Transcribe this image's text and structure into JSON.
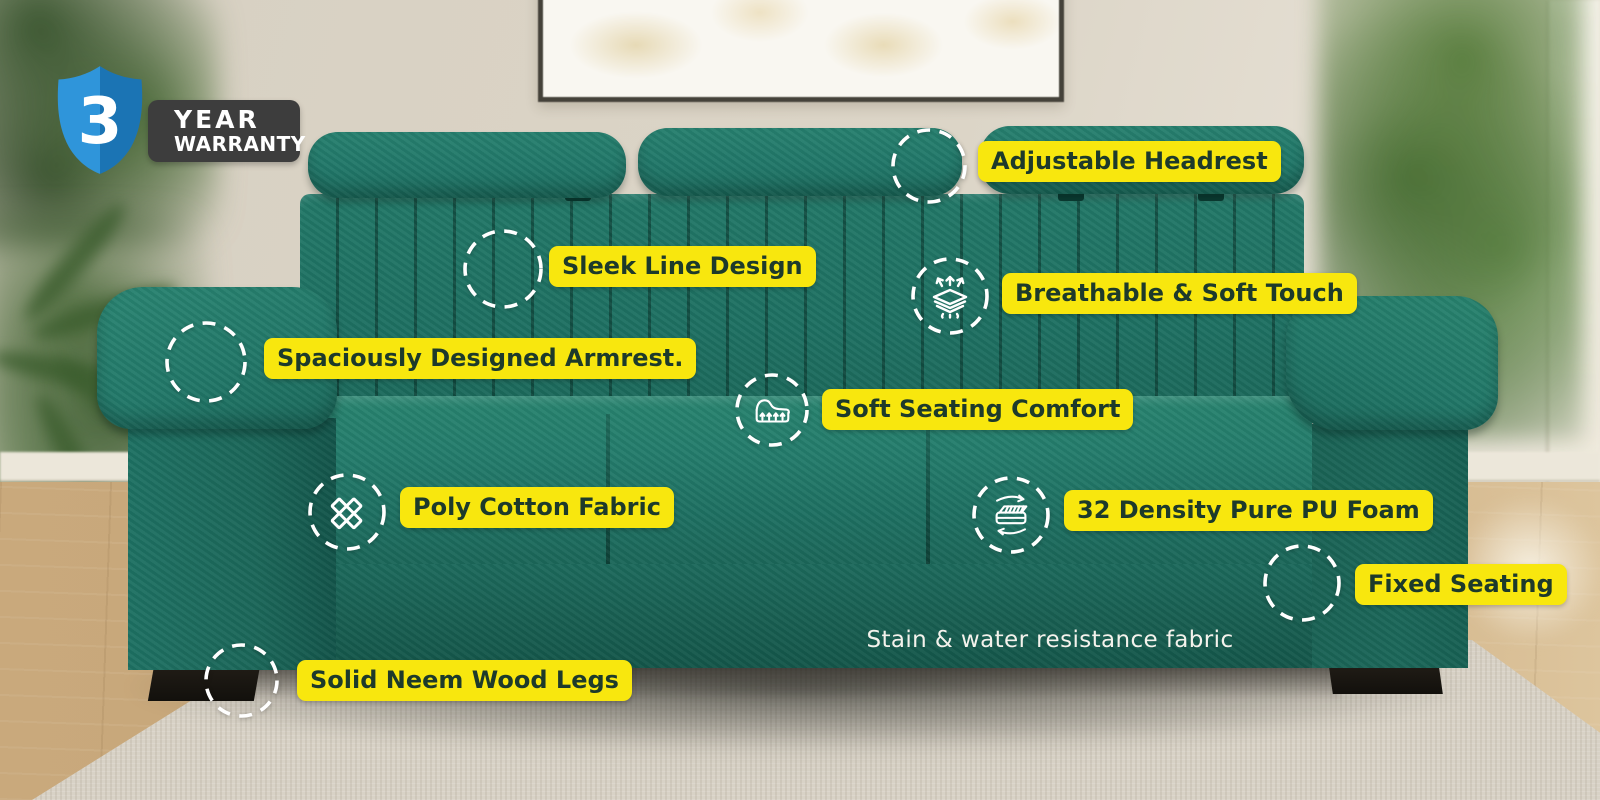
{
  "badge": {
    "years": "3",
    "line1": "YEAR",
    "line2": "WARRANTY"
  },
  "callouts": [
    {
      "id": "adjustable-headrest",
      "label": "Adjustable Headrest",
      "icon": "none"
    },
    {
      "id": "sleek-line-design",
      "label": "Sleek Line Design",
      "icon": "none"
    },
    {
      "id": "breathable-soft-touch",
      "label": "Breathable & Soft Touch",
      "icon": "breathable-fabric-icon"
    },
    {
      "id": "spacious-armrest",
      "label": "Spaciously Designed Armrest.",
      "icon": "none"
    },
    {
      "id": "soft-seating-comfort",
      "label": "Soft Seating Comfort",
      "icon": "seat-cushion-icon"
    },
    {
      "id": "poly-cotton-fabric",
      "label": "Poly Cotton Fabric",
      "icon": "fabric-weave-icon"
    },
    {
      "id": "pu-foam",
      "label": "32 Density Pure PU Foam",
      "icon": "foam-mattress-icon"
    },
    {
      "id": "fixed-seating",
      "label": "Fixed Seating",
      "icon": "none"
    },
    {
      "id": "neem-wood-legs",
      "label": "Solid Neem Wood Legs",
      "icon": "none"
    }
  ],
  "caption": "Stain & water resistance fabric",
  "colors": {
    "label_bg": "#f8e70e",
    "label_text": "#1d3a2b",
    "sofa_teal": "#1f7668",
    "shield_blue": "#2e93d9",
    "shield_blue_dark": "#1b74b4",
    "badge_bg": "#3d3d3d",
    "circle_stroke": "#ffffff"
  }
}
